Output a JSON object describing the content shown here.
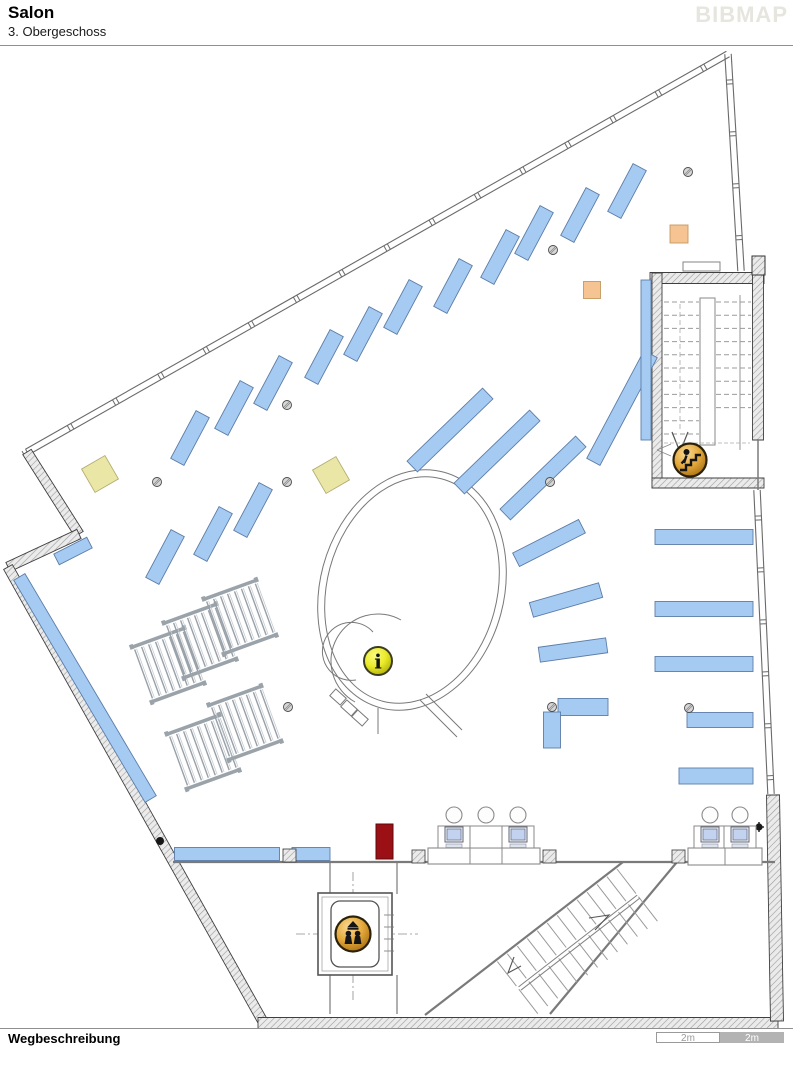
{
  "header": {
    "title": "Salon",
    "subtitle": "3. Obergeschoss",
    "logo": "BIBMAP"
  },
  "footer": {
    "label": "Wegbeschreibung",
    "scale_left": "2m",
    "scale_right": "2m"
  },
  "colors": {
    "shelf": "#a6cbf2",
    "shelf_border": "#5c7da8",
    "wall_edge": "#3f3f3f",
    "window": "#6a6a6a",
    "line": "#7a7a7a",
    "yellow": "#eae6a6",
    "yellow_border": "#b2ac72",
    "orange": "#f6c493",
    "orange_border": "#c49a60",
    "red_door": "#9b1014",
    "red_door_border": "#5f090b",
    "screen": "#c3d2ee",
    "monitor_body": "#eef1f6",
    "rack_rail": "#9aa2aa",
    "rack_rung": "#98a0a8"
  },
  "map": {
    "window_walls": [
      [
        728,
        54,
        27,
        452
      ],
      [
        728,
        54,
        741,
        271
      ],
      [
        757,
        490,
        771,
        794
      ]
    ],
    "hatched_walls": [
      [
        27,
        452,
        79,
        534,
        10
      ],
      [
        79,
        534,
        8,
        567,
        10
      ],
      [
        8,
        567,
        262,
        1020,
        10
      ],
      [
        258,
        1023,
        778,
        1023,
        11
      ],
      [
        773,
        795,
        777,
        1021,
        13
      ],
      [
        650,
        278,
        764,
        278,
        11
      ],
      [
        657,
        273,
        657,
        488,
        10
      ],
      [
        652,
        483,
        764,
        483,
        10
      ],
      [
        758,
        258,
        758,
        440,
        11
      ]
    ],
    "lines": [
      [
        173,
        862,
        775,
        862,
        2.2
      ],
      [
        330,
        862,
        330,
        894,
        1.2
      ],
      [
        397,
        862,
        397,
        894,
        1.2
      ],
      [
        330,
        975,
        330,
        1014,
        1.2
      ],
      [
        397,
        975,
        397,
        1014,
        1.2
      ],
      [
        623,
        862,
        425,
        1015,
        2.2
      ],
      [
        677,
        862,
        550,
        1014,
        2.2
      ],
      [
        758,
        440,
        758,
        490,
        1.5
      ],
      [
        740,
        295,
        740,
        450,
        0.8
      ]
    ],
    "dashdot": [
      [
        296,
        934,
        418,
        934
      ],
      [
        353,
        872,
        353,
        1002
      ]
    ],
    "shelves": [
      [
        627,
        191,
        54,
        15,
        -62
      ],
      [
        580,
        215,
        54,
        15,
        -62
      ],
      [
        534,
        233,
        54,
        15,
        -62
      ],
      [
        500,
        257,
        54,
        15,
        -62
      ],
      [
        453,
        286,
        54,
        15,
        -62
      ],
      [
        403,
        307,
        54,
        15,
        -62
      ],
      [
        363,
        334,
        54,
        15,
        -62
      ],
      [
        324,
        357,
        54,
        15,
        -62
      ],
      [
        273,
        383,
        54,
        15,
        -62
      ],
      [
        234,
        408,
        54,
        15,
        -62
      ],
      [
        190,
        438,
        54,
        15,
        -62
      ],
      [
        253,
        510,
        54,
        15,
        -62
      ],
      [
        213,
        534,
        54,
        15,
        -62
      ],
      [
        165,
        557,
        54,
        15,
        -62
      ],
      [
        73,
        551,
        37,
        12,
        -27
      ],
      [
        85,
        688,
        258,
        13,
        59.4
      ],
      [
        450,
        430,
        105,
        15,
        -44
      ],
      [
        497,
        452,
        105,
        15,
        -44
      ],
      [
        543,
        478,
        105,
        15,
        -44
      ],
      [
        622,
        408,
        122,
        15,
        -62
      ],
      [
        549,
        543,
        74,
        15,
        -27
      ],
      [
        566,
        600,
        72,
        15,
        -16
      ],
      [
        573,
        650,
        68,
        15,
        -8
      ],
      [
        583,
        707,
        50,
        17,
        0
      ],
      [
        552,
        730,
        36,
        17,
        90
      ],
      [
        704,
        537,
        98,
        15,
        0
      ],
      [
        704,
        609,
        98,
        15,
        0
      ],
      [
        704,
        664,
        98,
        15,
        0
      ],
      [
        720,
        720,
        66,
        15,
        0
      ],
      [
        716,
        776,
        74,
        16,
        0
      ],
      [
        646,
        360,
        160,
        10,
        90
      ],
      [
        227,
        854,
        105,
        13,
        0
      ],
      [
        311,
        854,
        38,
        13,
        0
      ]
    ],
    "yellow_squares": [
      [
        100,
        474,
        27,
        -30
      ],
      [
        331,
        475,
        27,
        -30
      ]
    ],
    "orange_squares": [
      [
        592,
        290,
        17,
        0
      ],
      [
        679,
        234,
        18,
        0
      ]
    ],
    "columns": [
      [
        157,
        482
      ],
      [
        287,
        482
      ],
      [
        287,
        405
      ],
      [
        553,
        250
      ],
      [
        550,
        482
      ],
      [
        688,
        172
      ],
      [
        689,
        708
      ],
      [
        552,
        707
      ],
      [
        288,
        707
      ]
    ],
    "wall_columns": [
      [
        283,
        849
      ],
      [
        412,
        850
      ],
      [
        543,
        850
      ],
      [
        672,
        850
      ]
    ],
    "black_dots": [
      [
        160,
        841
      ]
    ],
    "gear": [
      759,
      827
    ],
    "racks": [
      [
        168,
        665,
        -20
      ],
      [
        200,
        641,
        -20
      ],
      [
        240,
        617,
        -20
      ],
      [
        203,
        752,
        -20
      ],
      [
        245,
        723,
        -20
      ]
    ],
    "ellipse": {
      "cx": 412,
      "cy": 590,
      "rx": 92,
      "ry": 122,
      "rx2": 85,
      "ry2": 115,
      "rot": 15
    },
    "spiral": {
      "paths": [
        "M 401 620 A 47 47 0 1 0 355 702",
        "M 373 632 A 29 29 0 1 0 356 680",
        "M 378 708 L 378 734",
        "M 420 700 L 457 737",
        "M 426 694 L 462 730"
      ],
      "boxes": [
        [
          338,
          697
        ],
        [
          349,
          708
        ],
        [
          360,
          718
        ]
      ]
    },
    "stairs_tr": {
      "x": 664,
      "y": 302,
      "w": 88,
      "rows": 11,
      "gap": 13.2,
      "rail": [
        700,
        298,
        15,
        147
      ],
      "arrow": [
        672,
        432,
        680,
        452,
        688,
        432
      ]
    },
    "stairs_bottom": {
      "ax": 617,
      "ay": 869,
      "ux": -0.791,
      "uy": 0.612,
      "vx": 0.612,
      "vy": 0.791,
      "steps": 13,
      "gap": 12.6,
      "len": 31,
      "rail_off": 35,
      "rail_len": 150,
      "arrow1": "521,966 508,973 514,957",
      "arrow2": "595,930 609,915 589,918"
    },
    "elevator": {
      "x": 318,
      "y": 893,
      "w": 74,
      "h": 82,
      "comb_y": [
        915,
        927,
        939,
        951
      ]
    },
    "door_red": [
      376,
      824,
      17,
      35
    ],
    "top_door": [
      683,
      262,
      37,
      9
    ],
    "corner_block": [
      752,
      256,
      13,
      19
    ],
    "workstations": [
      {
        "x": 454,
        "monitor": true
      },
      {
        "x": 486,
        "monitor": false
      },
      {
        "x": 518,
        "monitor": true
      },
      {
        "x": 710,
        "monitor": true
      },
      {
        "x": 740,
        "monitor": true
      }
    ],
    "platforms": [
      {
        "r": [
          428,
          848,
          112,
          16
        ],
        "div": [
          470,
          502
        ]
      },
      {
        "r": [
          688,
          848,
          74,
          17
        ],
        "div": [
          725
        ]
      }
    ],
    "icons": {
      "info": [
        378,
        661,
        14
      ],
      "escalator": [
        690,
        460,
        16.5
      ],
      "elevator": [
        353,
        934,
        17.5
      ]
    },
    "esc_room": {
      "dash": [
        664,
        443,
        750,
        443
      ],
      "chev": [
        [
          657,
          450,
          671,
          444
        ],
        [
          657,
          450,
          671,
          456
        ]
      ]
    }
  }
}
